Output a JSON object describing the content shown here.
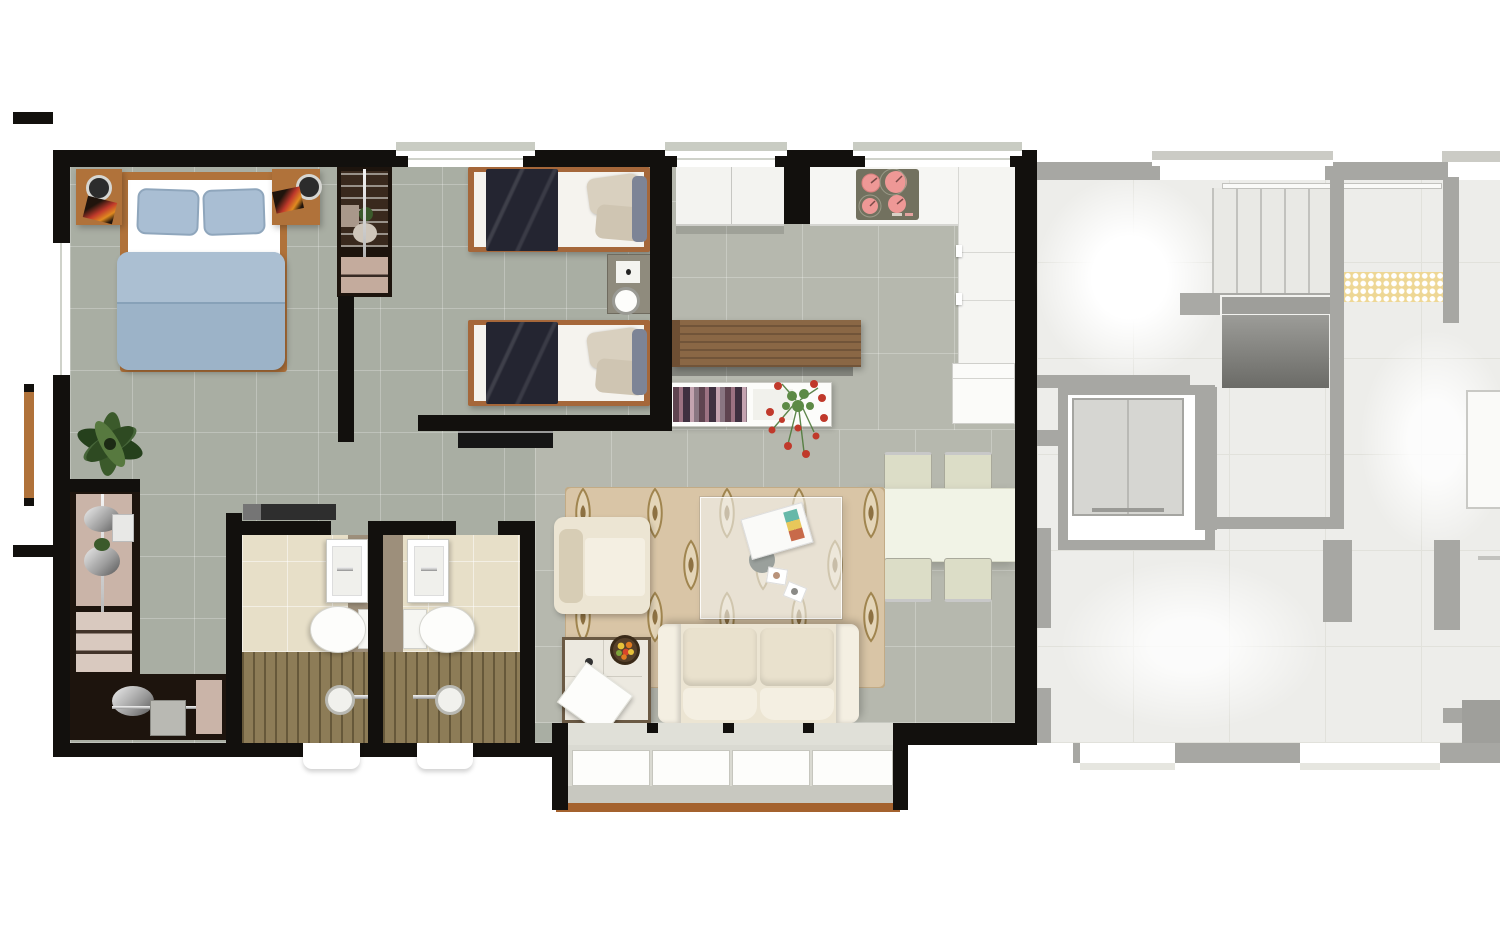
{
  "meta": {
    "type": "architectural-floorplan-render",
    "view": "top-down",
    "canvas_width_px": 1500,
    "canvas_height_px": 938
  },
  "palette": {
    "wall": "#12100d",
    "ghost-wall": "#a7a7a3",
    "ghost-line": "#e1e1db",
    "ghost-void": "#7e7e7a",
    "ghost-car": "#d6d6d2",
    "floor-bed": "#a9aea3",
    "floor-liv": "#b6b8ae",
    "floor-bath": "#e7dfc8",
    "floor-ghost": "#ededea",
    "tile-line": "rgba(255,255,255,0.25)",
    "sill": "#c9ccc3",
    "concrete": "#dadad2",
    "concrete-dk": "#c8c8c0",
    "wood": "#b0723a",
    "wood-bar": "#8a6745",
    "wood-edge": "#a4622e",
    "deck": "#8d7c57",
    "duvet": "#9cb3c8",
    "duvet-lt": "#abbfd2",
    "pillow": "#a9bed3",
    "navy": "#242531",
    "cream": "#ece5d3",
    "cream-dk": "#d7cdb5",
    "cream-lt": "#f4efe2",
    "rug": "#d9c5a6",
    "rug-fill": "#e4d5b8",
    "rug-line": "#a0854f",
    "rug-dot": "#8d7142",
    "glass": "rgba(243,245,243,0.58)",
    "chrome": "#c6c6c6",
    "stove": "#72715f",
    "burner": "#ee9896",
    "burner-dk": "#d77f7d",
    "plant": "#3b5a2b",
    "plant-dk": "#25401c",
    "red": "#c0392b",
    "yellow": "#eed795",
    "bath-band": "#9d8f7b",
    "nook-dark": "#1d140d",
    "nook-panel": "#cab4a8",
    "book-a": "#5f4450",
    "book-b": "#9c7282",
    "book-c": "#3f3040",
    "book-d": "#c4a3b0",
    "table-top": "#f1f3e6",
    "chair": "#dcddc7",
    "white": "#ffffff"
  },
  "units": {
    "main": {
      "name": "furnished-apartment-unit",
      "style": "full-color-render",
      "rooms": [
        {
          "name": "master-bedroom",
          "furniture": [
            "double-bed",
            "blue-duvet",
            "two-pillows",
            "nightstand-left",
            "nightstand-right",
            "speaker-left",
            "speaker-right",
            "art-book-left",
            "art-book-right",
            "wardrobe",
            "floor-plant"
          ]
        },
        {
          "name": "bedroom-2",
          "furniture": [
            "single-bed-1",
            "single-bed-2",
            "navy-blankets",
            "beige-pillows",
            "nightstand",
            "table-clock",
            "tv-shelf"
          ]
        },
        {
          "name": "kitchen",
          "furniture": [
            "upper-cabinets",
            "cooktop-counter",
            "cooktop-4-burners",
            "tall-counter",
            "fridge",
            "wood-breakfast-bar",
            "sideboard-with-books",
            "red-flower-arrangement"
          ]
        },
        {
          "name": "dining-area",
          "furniture": [
            "dining-table",
            "dining-chair-x4"
          ]
        },
        {
          "name": "living-room",
          "furniture": [
            "two-seat-sofa",
            "armchair",
            "glass-coffee-table",
            "magazine",
            "coasters",
            "side-table",
            "fruit-bowl",
            "paper-sheet",
            "ogee-pattern-rug"
          ]
        },
        {
          "name": "bathroom-1",
          "furniture": [
            "vanity-sink",
            "toilet",
            "wood-shower-deck",
            "shower-head",
            "hall-console"
          ]
        },
        {
          "name": "bathroom-2",
          "furniture": [
            "vanity-sink",
            "toilet",
            "wood-shower-deck",
            "shower-head"
          ]
        },
        {
          "name": "utility-nook",
          "furniture": [
            "l-shaped-appliance-counter",
            "chrome-fixtures"
          ]
        },
        {
          "name": "balcony",
          "furniture": [
            "sliding-glass-panels-x4",
            "concrete-floor",
            "wood-edge"
          ]
        },
        {
          "name": "side-terrace",
          "furniture": [
            "wood-side-door"
          ]
        }
      ],
      "window_count": 4,
      "burner_count": 4,
      "sliding_panel_count": 4,
      "dining_chair_count": 4
    },
    "adjacent": {
      "name": "ghosted-common-area",
      "style": "faded-grayscale-overlay",
      "features": [
        "staircase-treads",
        "stair-landing",
        "stair-void",
        "elevator-shaft",
        "elevator-car",
        "tactile-paving-mat",
        "corridor",
        "neighbor-unit-fragments",
        "window-sills"
      ]
    }
  }
}
